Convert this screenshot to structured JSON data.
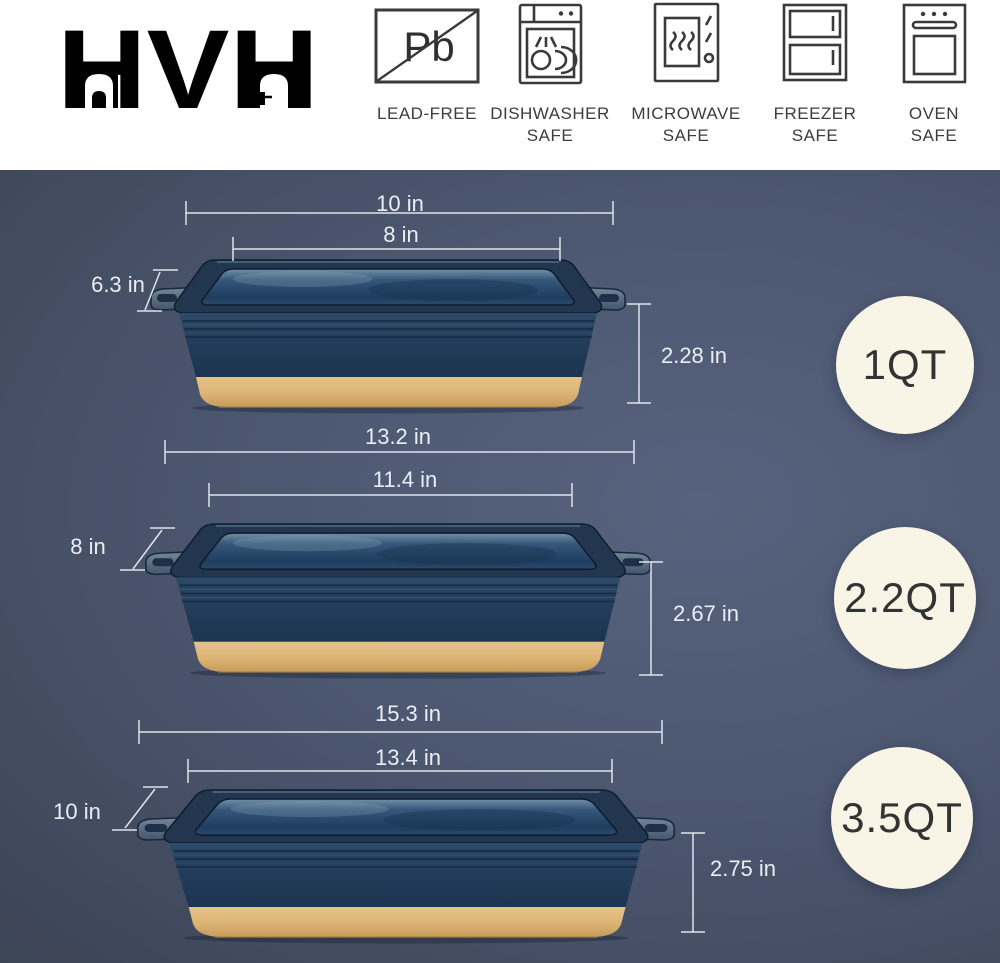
{
  "header": {
    "logo_text": "HVH",
    "badges": [
      {
        "name": "lead-free",
        "symbol": "Pb",
        "lines": [
          "LEAD-FREE",
          ""
        ]
      },
      {
        "name": "dishwasher-safe",
        "lines": [
          "DISHWASHER",
          "SAFE"
        ]
      },
      {
        "name": "microwave-safe",
        "lines": [
          "MICROWAVE",
          "SAFE"
        ]
      },
      {
        "name": "freezer-safe",
        "lines": [
          "FREEZER",
          "SAFE"
        ]
      },
      {
        "name": "oven-safe",
        "lines": [
          "OVEN",
          "SAFE"
        ]
      }
    ]
  },
  "products": [
    {
      "capacity": "1QT",
      "outer_length": "10 in",
      "inner_length": "8 in",
      "width": "6.3 in",
      "height": "2.28 in"
    },
    {
      "capacity": "2.2QT",
      "outer_length": "13.2 in",
      "inner_length": "11.4 in",
      "width": "8 in",
      "height": "2.67 in"
    },
    {
      "capacity": "3.5QT",
      "outer_length": "15.3 in",
      "inner_length": "13.4 in",
      "width": "10 in",
      "height": "2.75 in"
    }
  ],
  "colors": {
    "dish_navy": "#223a55",
    "dish_tan": "#dcb475",
    "capacity_circle": "#f8f4e6",
    "background_dark": "#39414f",
    "background_light": "#57637e",
    "dimension_text": "#eaeef4"
  }
}
